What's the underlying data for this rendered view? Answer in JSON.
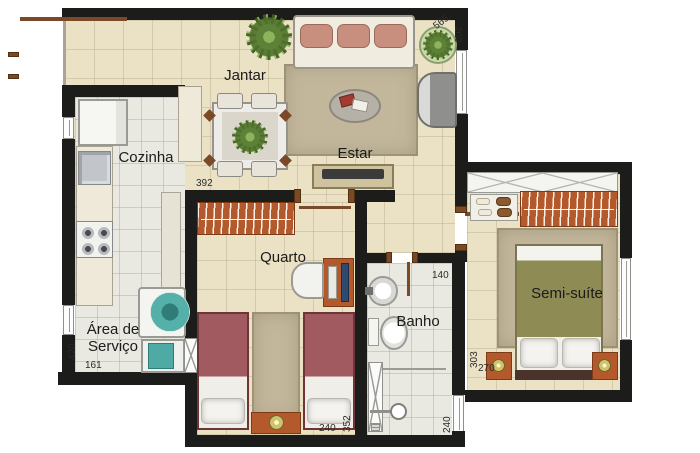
{
  "meta": {
    "type": "apartment floor plan (planta baixa)",
    "language": "pt-BR"
  },
  "rooms": {
    "jantar": "Jantar",
    "estar": "Estar",
    "cozinha": "Cozinha",
    "quarto": "Quarto",
    "banho": "Banho",
    "semi_suite": "Semi-suíte",
    "area_servico_line1": "Área de",
    "area_servico_line2": "Serviço"
  },
  "dims": {
    "d565": "565",
    "d260": "260",
    "d392": "392",
    "d140": "140",
    "d303": "303",
    "d270": "270",
    "d420": "420",
    "d161": "161",
    "d352": "352",
    "d240_quarto": "240",
    "d240_banho": "240"
  },
  "colors": {
    "wall": "#1c1c1a",
    "beige": "#ebe2c6",
    "gray_floor": "#e9e8e1",
    "rug": "#c2b69b",
    "brown": "#7a4a28",
    "orange": "#b4592b",
    "orange_dark": "#7c3a17",
    "maroon": "#a05a60",
    "maroon_dark": "#6e3437",
    "olive": "#8e8b55",
    "teal": "#4fa9a4",
    "cream": "#efe9da",
    "label": "#1b1b1b"
  }
}
